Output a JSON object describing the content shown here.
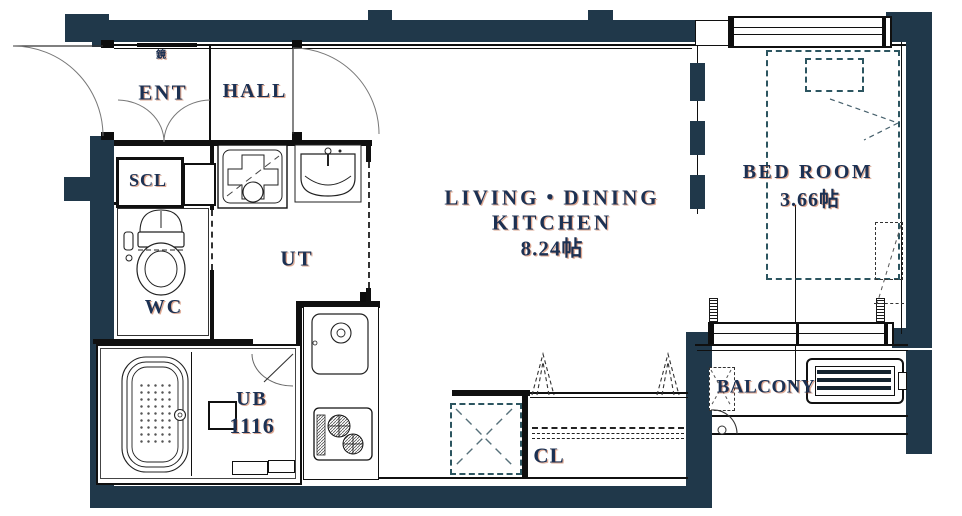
{
  "title": "apartment-floor-plan",
  "colors": {
    "wall": "#20384a",
    "text": "#1c3153",
    "dash_accent": "#2c5560",
    "line": "#101010"
  },
  "labels": {
    "mirror": "鏡",
    "ent": "ENT",
    "hall": "HALL",
    "scl": "SCL",
    "wc": "WC",
    "ut": "UT",
    "ub": "UB",
    "ub_size": "1116",
    "ldk_line1": "LIVING・DINING",
    "ldk_line2": "KITCHEN",
    "ldk_area": "8.24帖",
    "bedroom": "BED ROOM",
    "bedroom_area": "3.66帖",
    "closet": "CL",
    "balcony": "BALCONY"
  }
}
